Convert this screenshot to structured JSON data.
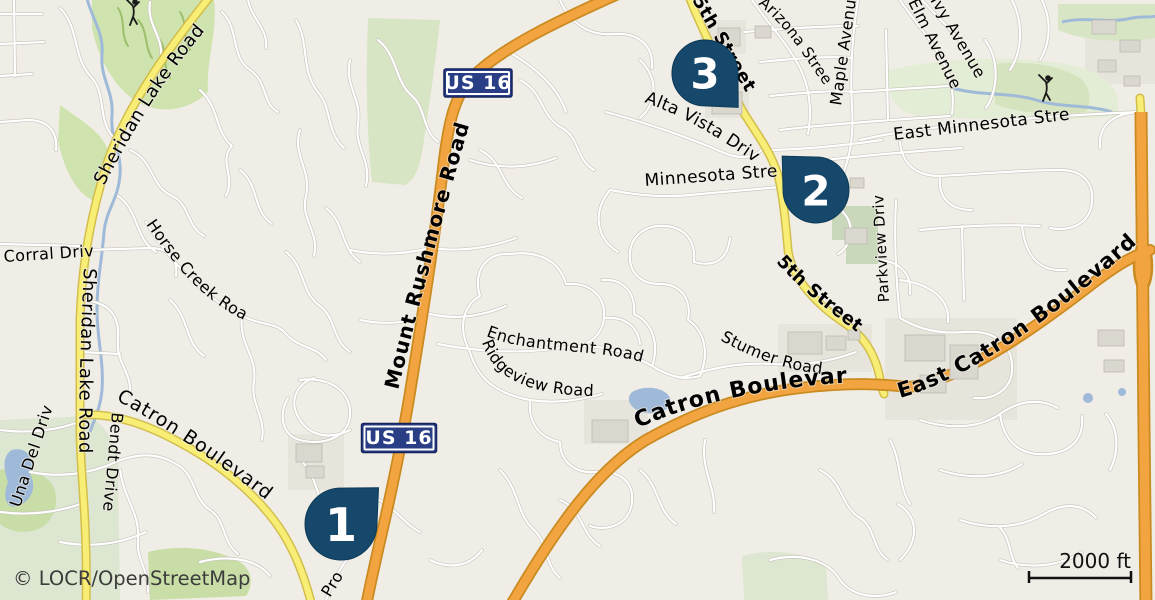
{
  "map": {
    "attribution": "© LOCR/OpenStreetMap",
    "scale": {
      "label": "2000 ft"
    },
    "shields": [
      {
        "label": "US 16",
        "x": 478,
        "y": 83,
        "w": 68,
        "h": 28
      },
      {
        "label": "US 16",
        "x": 399,
        "y": 438,
        "w": 75,
        "h": 29
      }
    ],
    "markers": [
      {
        "number": "1",
        "x": 341,
        "y": 524,
        "r": 36,
        "angle": -44
      },
      {
        "number": "2",
        "x": 816,
        "y": 190,
        "r": 33,
        "angle": -135
      },
      {
        "number": "3",
        "x": 705,
        "y": 73,
        "r": 33,
        "angle": 46
      }
    ],
    "road_labels": [
      {
        "id": "sheridan-top",
        "text": "Sheridan Lake Road"
      },
      {
        "id": "sheridan-left",
        "text": "Sheridan Lake Road"
      },
      {
        "id": "corral",
        "text": "Corral Drive"
      },
      {
        "id": "horse-creek",
        "text": "Horse Creek Road"
      },
      {
        "id": "mount-rushmore",
        "text": "Mount Rushmore Road"
      },
      {
        "id": "fifth-top",
        "text": "5th Street"
      },
      {
        "id": "arizona",
        "text": "Arizona Street"
      },
      {
        "id": "maple",
        "text": "Maple Avenue"
      },
      {
        "id": "elm",
        "text": "Elm Avenue"
      },
      {
        "id": "ivy",
        "text": "Ivy Avenue"
      },
      {
        "id": "east-minnesota",
        "text": "East Minnesota Street"
      },
      {
        "id": "alta-vista",
        "text": "Alta Vista Drive"
      },
      {
        "id": "minnesota",
        "text": "Minnesota Street"
      },
      {
        "id": "parkview",
        "text": "Parkview Drive"
      },
      {
        "id": "fifth-mid",
        "text": "5th Street"
      },
      {
        "id": "stumer",
        "text": "Stumer Road"
      },
      {
        "id": "enchantment",
        "text": "Enchantment Road"
      },
      {
        "id": "ridgeview",
        "text": "Ridgeview Road"
      },
      {
        "id": "catron-center",
        "text": "Catron Boulevard"
      },
      {
        "id": "east-catron",
        "text": "East Catron Boulevard"
      },
      {
        "id": "catron-west",
        "text": "Catron Boulevard"
      },
      {
        "id": "bendt",
        "text": "Bendt Drive"
      },
      {
        "id": "una-del",
        "text": "Una Del Drive"
      },
      {
        "id": "promise-partial",
        "text": "Pro"
      }
    ],
    "icons": [
      {
        "name": "golfer-icon",
        "x": 133,
        "y": 12
      },
      {
        "name": "golfer-icon",
        "x": 1046,
        "y": 88
      }
    ],
    "colors": {
      "background": "#f0ede6",
      "road_orange": "#f2a440",
      "road_orange_casing": "#c98b20",
      "road_yellow": "#f8ee76",
      "road_yellow_casing": "#d2be4c",
      "road_white": "#ffffff",
      "road_white_casing": "#c6c2ba",
      "water": "#9fbad8",
      "park_green": "#cfe3ae",
      "sage_green": "#dce6d0",
      "golf_green": "#e3ecd4",
      "building_gray": "#dad7cf",
      "urban_gray": "#e7e4dc",
      "marker_blue": "#15486b",
      "shield_blue": "#293e85",
      "label_black": "#000000"
    }
  }
}
